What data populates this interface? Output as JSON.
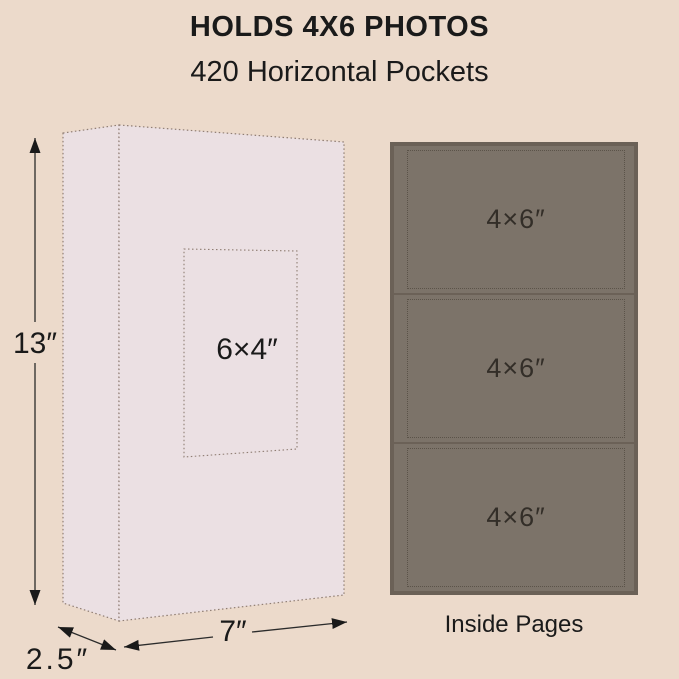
{
  "header": {
    "title": "HOLDS 4X6 PHOTOS",
    "subtitle": "420 Horizontal Pockets"
  },
  "album": {
    "front_window_label": "6×4″",
    "height_label": "13″",
    "depth_label": "2.5″",
    "width_label": "7″"
  },
  "inside_pages": {
    "caption": "Inside Pages",
    "pockets": [
      {
        "label": "4×6″"
      },
      {
        "label": "4×6″"
      },
      {
        "label": "4×6″"
      }
    ]
  },
  "colors": {
    "background": "#ecdacb",
    "box_fill": "#ebe0e3",
    "outline": "#8f7d73",
    "panel_fill": "#7c7369",
    "panel_border": "#6b6157",
    "pocket_outline": "#5b5349",
    "panel_text": "#332e28",
    "text": "#1a1a1a"
  }
}
